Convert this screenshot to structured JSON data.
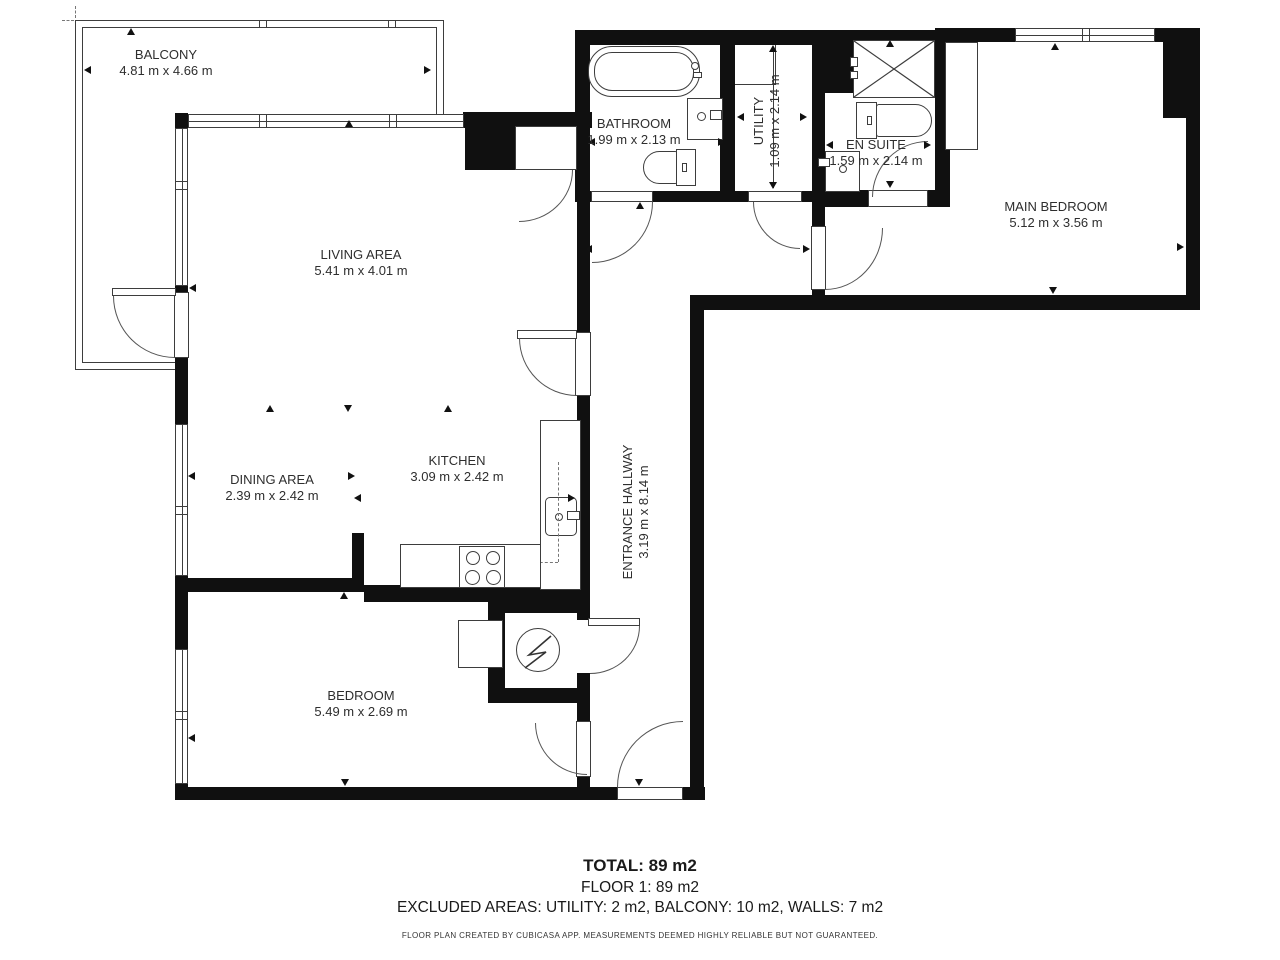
{
  "rooms": {
    "balcony": {
      "name": "BALCONY",
      "dims": "4.81 m x 4.66 m"
    },
    "living": {
      "name": "LIVING AREA",
      "dims": "5.41 m x 4.01 m"
    },
    "dining": {
      "name": "DINING AREA",
      "dims": "2.39 m x 2.42 m"
    },
    "kitchen": {
      "name": "KITCHEN",
      "dims": "3.09 m x 2.42 m"
    },
    "bathroom": {
      "name": "BATHROOM",
      "dims": "1.99 m x 2.13 m"
    },
    "utility": {
      "name": "UTILITY",
      "dims": "1.09 m x 2.14 m"
    },
    "ensuite": {
      "name": "EN SUITE",
      "dims": "1.59 m x 2.14 m"
    },
    "main_bedroom": {
      "name": "MAIN BEDROOM",
      "dims": "5.12 m x 3.56 m"
    },
    "hallway": {
      "name": "ENTRANCE HALLWAY",
      "dims": "3.19 m x 8.14 m"
    },
    "bedroom": {
      "name": "BEDROOM",
      "dims": "5.49 m x 2.69 m"
    }
  },
  "summary": {
    "total": "TOTAL: 89 m2",
    "floor": "FLOOR 1: 89 m2",
    "excluded": "EXCLUDED AREAS: UTILITY: 2 m2, BALCONY: 10 m2, WALLS: 7 m2",
    "disclaimer": "FLOOR PLAN CREATED BY CUBICASA APP. MEASUREMENTS DEEMED HIGHLY RELIABLE BUT NOT GUARANTEED."
  },
  "colors": {
    "wall": "#101010",
    "line": "#3d3d3d",
    "text": "#2e2e2e"
  }
}
